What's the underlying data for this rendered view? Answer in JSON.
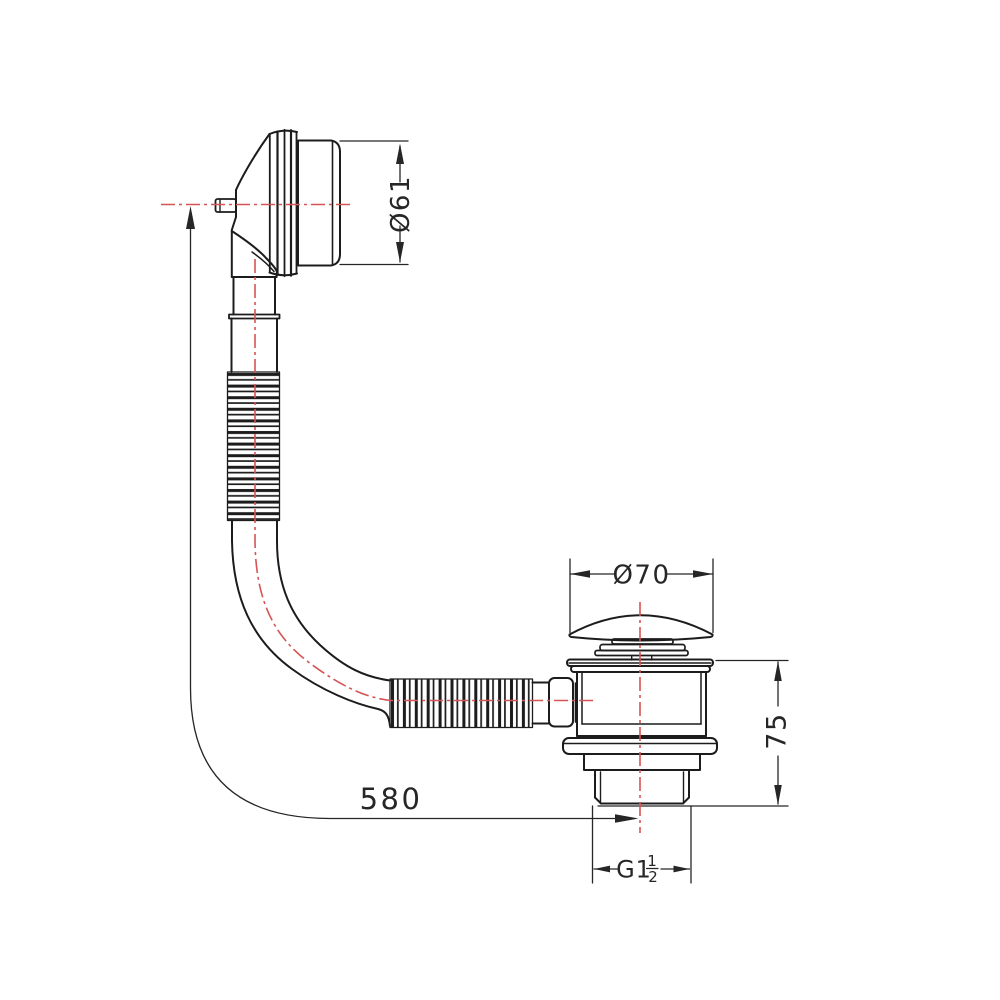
{
  "drawing": {
    "labels": {
      "overflow_diameter": "Ø61",
      "plug_diameter": "Ø70",
      "waste_height": "75",
      "hose_length": "580",
      "thread_prefix": "G1",
      "thread_numerator": "1",
      "thread_denominator": "2"
    },
    "colors": {
      "outline": "#1c1c1c",
      "dimension": "#262626",
      "centerline": "#d65454",
      "background": "#ffffff"
    }
  }
}
